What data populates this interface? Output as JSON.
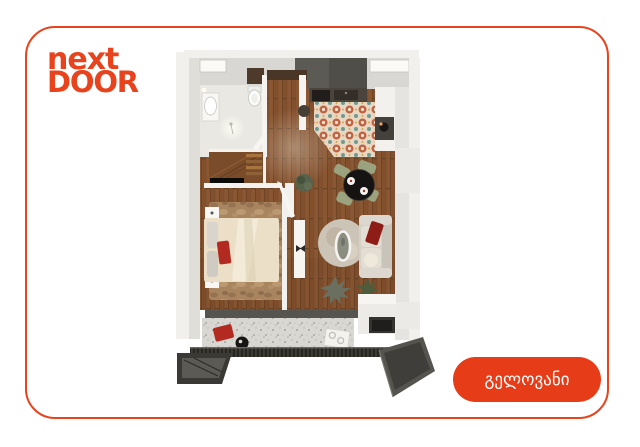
{
  "window": {
    "width_px": 640,
    "height_px": 447,
    "background": "#ffffff"
  },
  "logo": {
    "line1": "next",
    "line2": "DOOR"
  },
  "cta": {
    "label": "გელოვანი"
  },
  "colors": {
    "brand": "#e8401c",
    "card_border": "#e8431c",
    "button_bg": "#e63c17",
    "button_text": "#ffffff",
    "logo_text": "#e8431c",
    "wall": "#d9d7d3",
    "wall_light": "#f2f0ed",
    "wall_dark": "#504e48",
    "wood": "#8a5733",
    "tile_base": "#e8d8c3",
    "tile_flower": "#c16242",
    "tile_leaf": "#6f9a92",
    "bath_floor": "#eae8e3",
    "bed_duvet": "#ebdfc7",
    "bedroom_rug": "#a8855f",
    "living_rug": "#ccc4b7",
    "sofa": "#d6d1c7",
    "accent_red": "#b22a20",
    "dining_table": "#151413",
    "chair_green": "#9aa37e",
    "terrazzo": "#d9d7d2",
    "railing": "#272621",
    "slab": "#4b4947"
  }
}
